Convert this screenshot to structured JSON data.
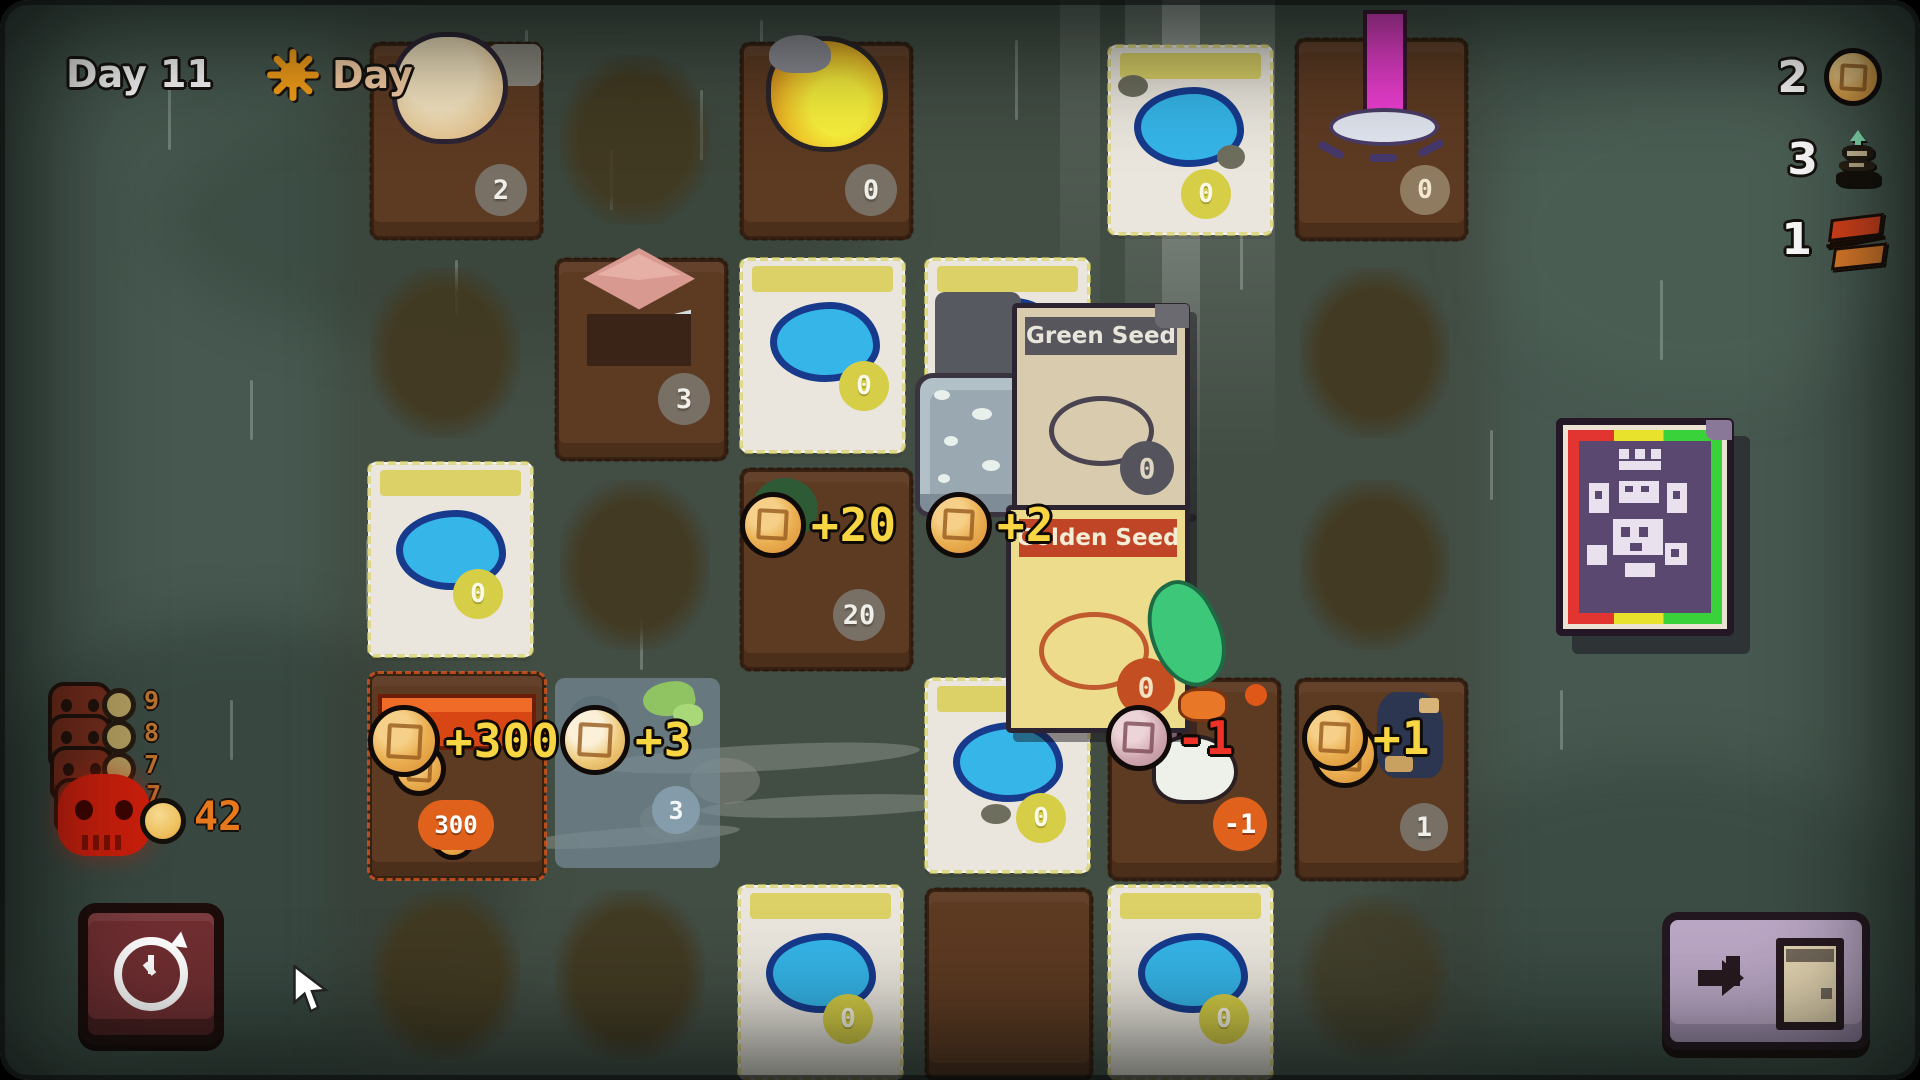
{
  "hud": {
    "day_counter": "Day 11",
    "phase": {
      "icon": "sun-icon",
      "label": "Day"
    },
    "resources": [
      {
        "icon": "coin-icon",
        "count": "2"
      },
      {
        "icon": "seedling-icon",
        "count": "3"
      },
      {
        "icon": "bricks-icon",
        "count": "1"
      }
    ]
  },
  "threat_panel": {
    "icon": "skull-icon",
    "upcoming_costs": [
      "9",
      "8",
      "7",
      "7"
    ],
    "coin_icon": "coin-icon",
    "total": "42"
  },
  "board": {
    "badges": {
      "sand": "2",
      "lamp": "0",
      "puddle_ne": "0",
      "beacon": "0",
      "house": "3",
      "puddle_n": "0",
      "puddle_w": "0",
      "plot": "20",
      "market": "300",
      "plant": "3",
      "puddle_s": "0",
      "pig": "-1",
      "worker": "1",
      "puddle_sw": "0",
      "puddle_se": "0"
    },
    "floaters": {
      "plot": "+20",
      "seed": "+2",
      "market": "+300",
      "plant": "+3",
      "pig": "-1",
      "worker": "+1"
    }
  },
  "cards": {
    "green_seed": {
      "title": "Green Seed",
      "count": "0"
    },
    "golden_seed": {
      "title": "Golden Seed",
      "count": "0"
    }
  },
  "buttons": {
    "undo": {
      "icon": "history-clock-icon"
    },
    "end_day": {
      "icon": "arrow-door-icon"
    }
  },
  "colors": {
    "coin_gold": "#ecbc50",
    "floater_yellow": "#f8d542",
    "damage_red": "#f03226",
    "badge_orange": "#e0611c",
    "badge_yellow": "#d6ce46",
    "skull_red": "#c81e0c",
    "background_teal": "#46584f"
  }
}
